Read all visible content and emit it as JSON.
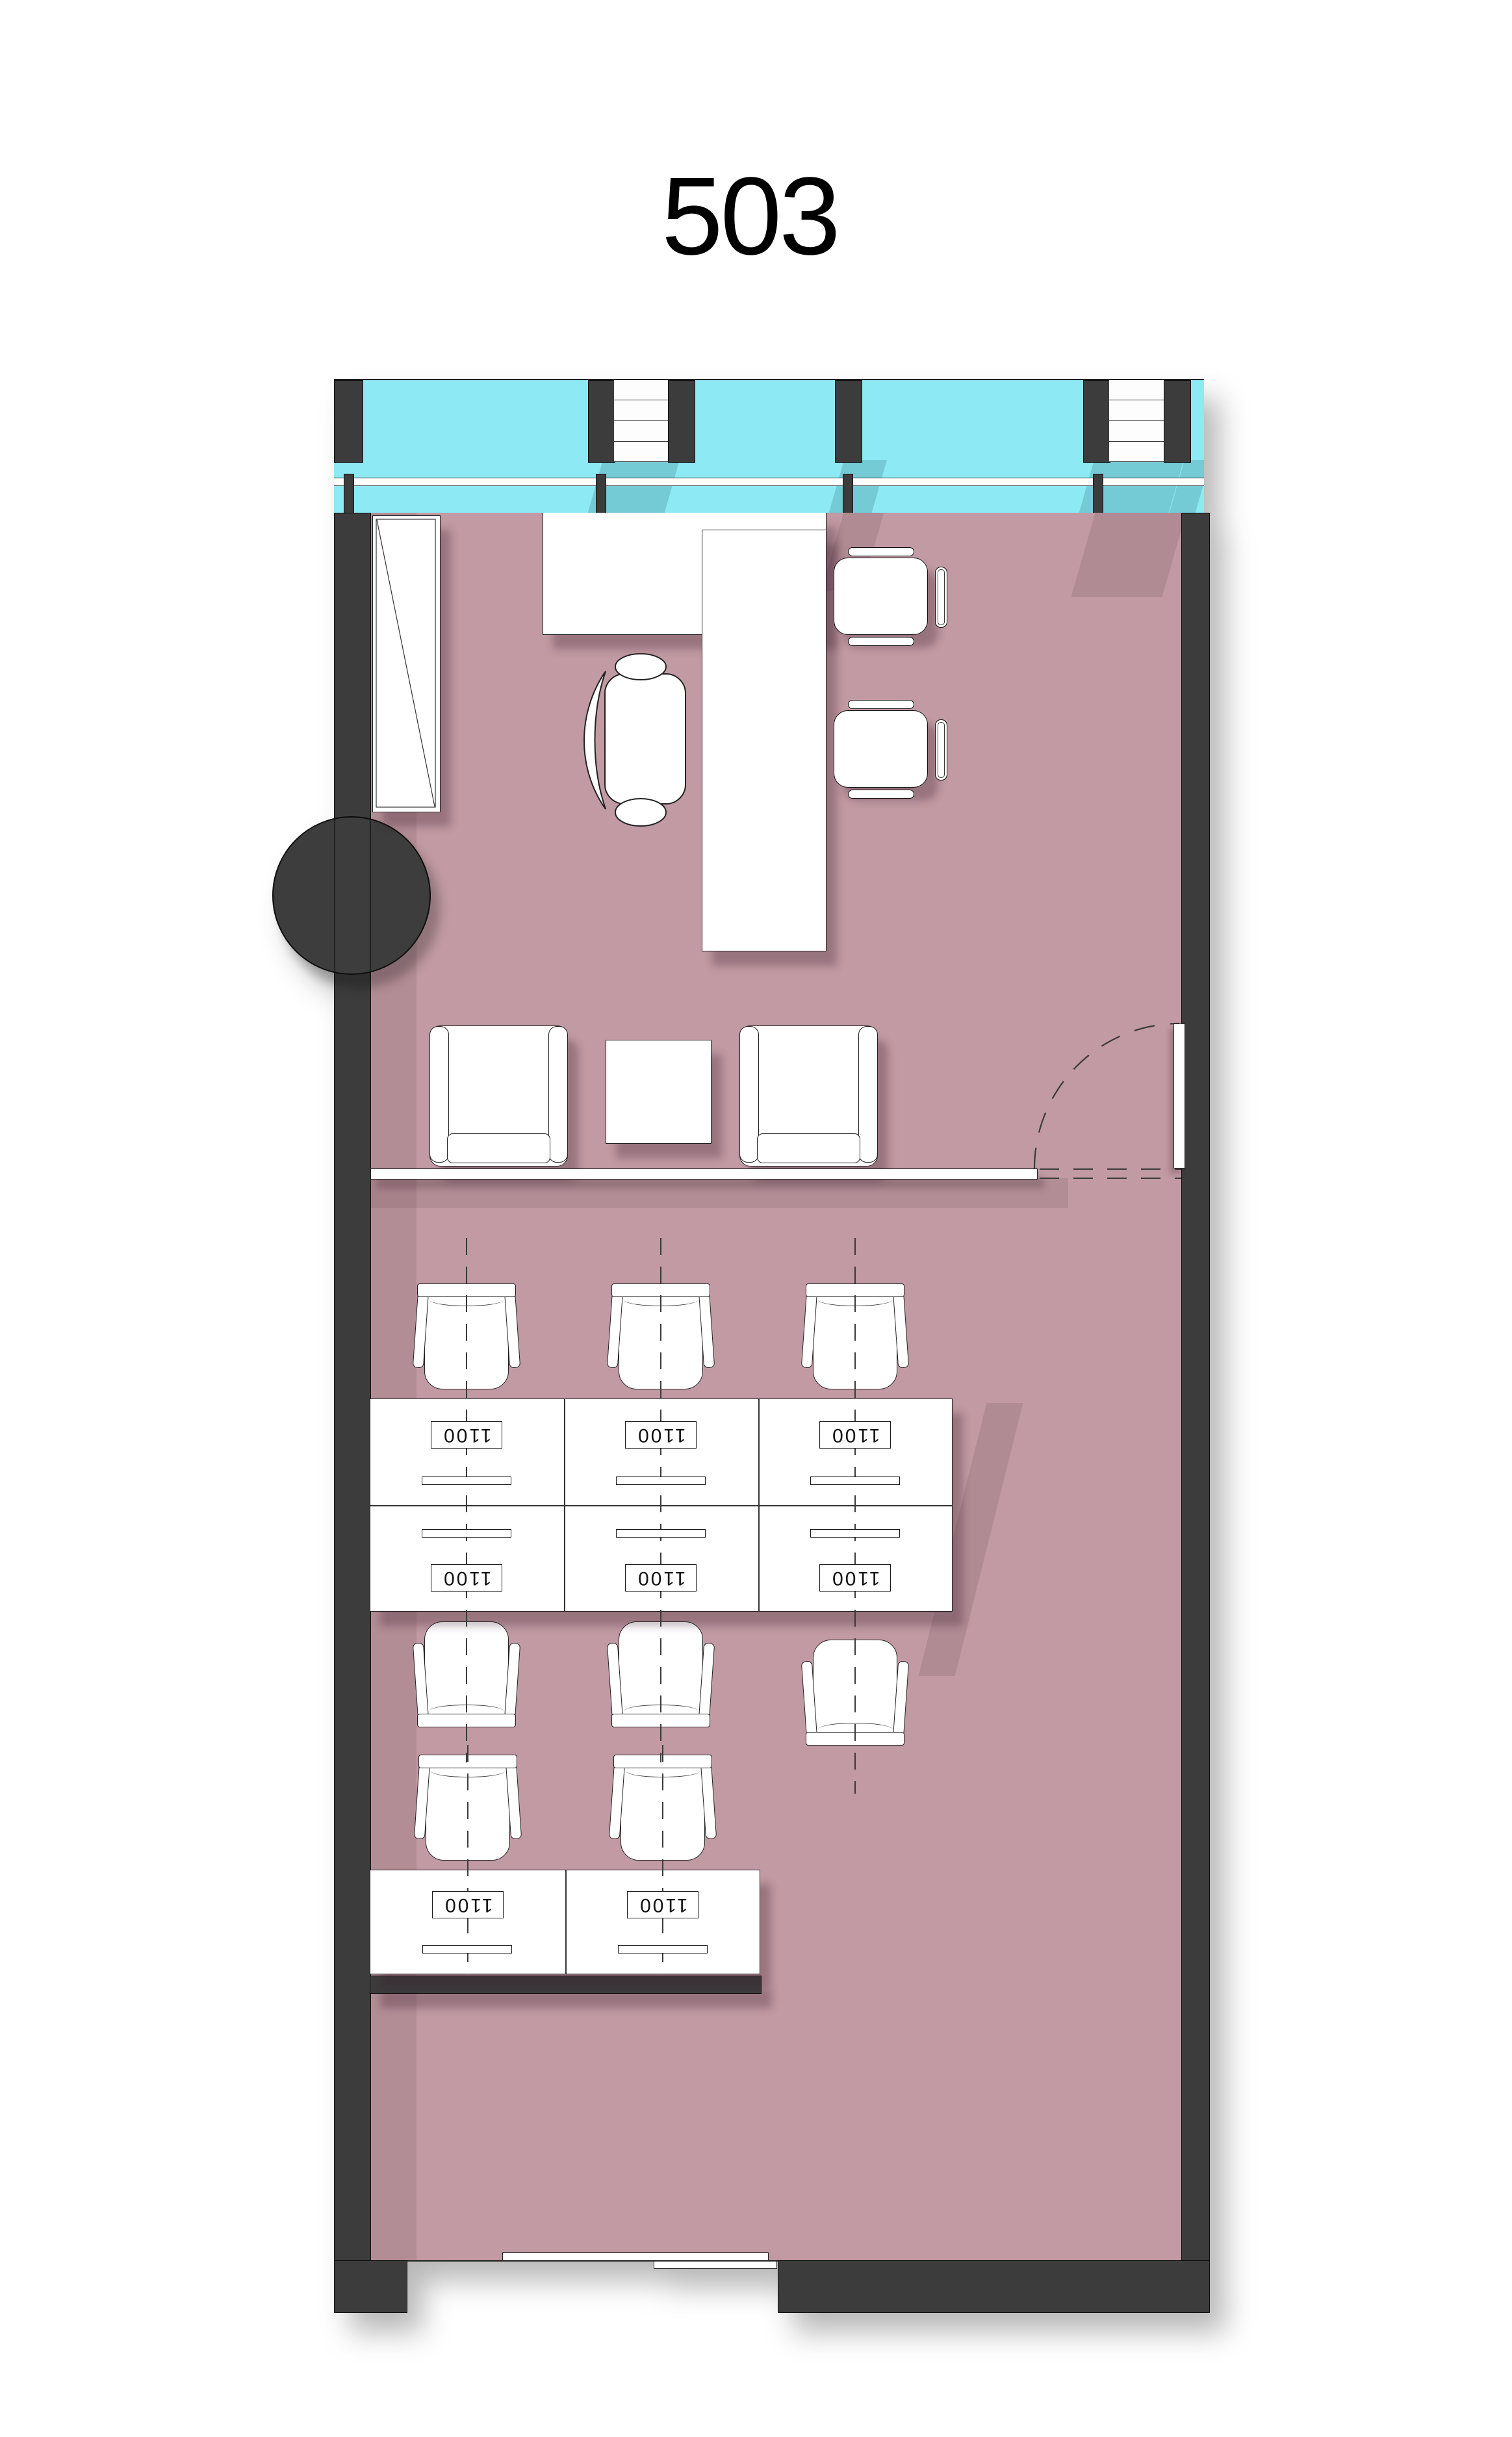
{
  "title": "503",
  "workstations": {
    "block1_labels": [
      "1100",
      "1100",
      "1100",
      "1100",
      "1100",
      "1100"
    ],
    "block2_labels": [
      "1100",
      "1100"
    ]
  },
  "colors": {
    "wall": "#3c3c3c",
    "glass": "#8de9f3",
    "floor": "#c19aa3",
    "furniture_fill": "#ffffff",
    "line": "#222222"
  }
}
